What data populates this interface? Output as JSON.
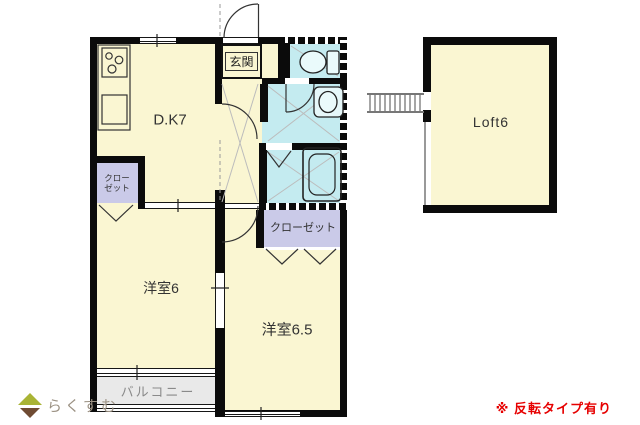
{
  "colors": {
    "floor": "#FAF6D2",
    "wet_area": "#C4EBF0",
    "closet": "#CACAE8",
    "balcony": "#E9E9E9",
    "wall": "#0B0B0B",
    "note_red": "#E60000",
    "logo_text": "#9B9183",
    "logo_green": "#A9B435",
    "logo_brown": "#6F4B32"
  },
  "labels": {
    "dk": "D.K7",
    "entrance": "玄関",
    "loft": "Loft6",
    "western_room_1": "洋室6",
    "western_room_2": "洋室6.5",
    "closet_small_line1": "クロー",
    "closet_small_line2": "ゼット",
    "closet_large": "クローゼット",
    "balcony": "バルコニー"
  },
  "footer": {
    "logo": "らくすむ",
    "note": "※ 反転タイプ有り"
  },
  "icons": {
    "stove": "stove-icon",
    "kitchen_sink": "kitchen-sink-icon",
    "toilet": "toilet-icon",
    "washbasin": "washbasin-icon",
    "bathtub": "bathtub-icon",
    "ladder": "ladder-icon",
    "logo_house": "house-logo-icon"
  }
}
